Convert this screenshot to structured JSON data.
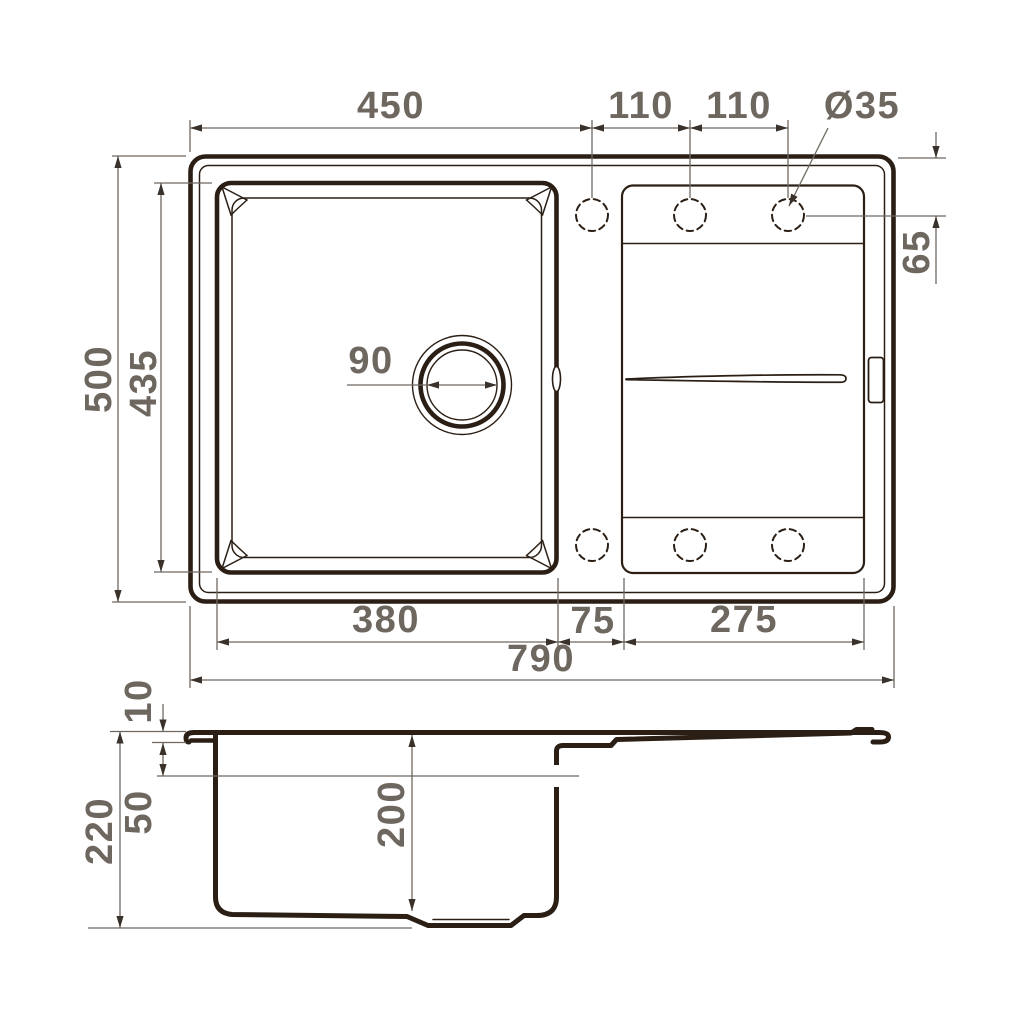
{
  "drawing": {
    "type": "sink-dimension-drawing",
    "line_color": "#2b1f15",
    "dim_color": "#6f6862",
    "text_color": "#6e6760",
    "background": "#ffffff"
  },
  "dims": {
    "top_view": {
      "edge_to_first_hole": "450",
      "hole_spacing_1": "110",
      "hole_spacing_2": "110",
      "hole_diameter": "Ø35",
      "drain_diameter": "90",
      "hole_offset_from_top_edge": "65",
      "overall_depth": "500",
      "bowl_inner_depth": "435",
      "bowl_width": "380",
      "divider_width": "75",
      "drainboard_width": "275",
      "overall_width": "790"
    },
    "side_view": {
      "rim_height": "10",
      "rim_to_waterline": "50",
      "overall_height": "220",
      "bowl_depth": "200"
    }
  }
}
